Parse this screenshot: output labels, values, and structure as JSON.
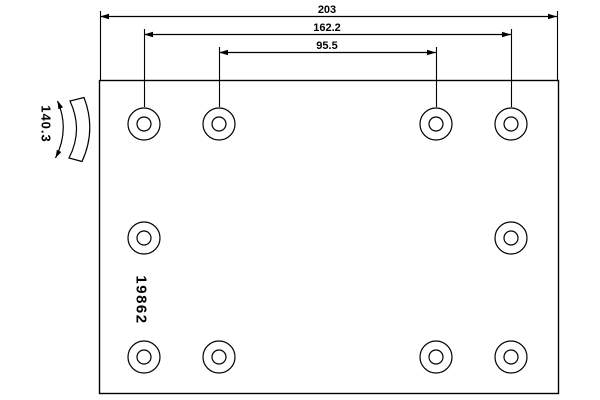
{
  "drawing": {
    "part_number": "19862",
    "dimensions": {
      "total_width": "203",
      "outer_hole_span": "162.2",
      "inner_hole_span": "95.5",
      "lining_width": "140.3"
    },
    "colors": {
      "line": "#000000",
      "background": "#ffffff"
    },
    "geometry": {
      "plate": {
        "x": 99,
        "y": 80,
        "width": 459,
        "height": 313
      },
      "holes": {
        "columns_x": [
          144,
          219,
          436,
          511
        ],
        "rows_y": [
          124,
          238,
          357
        ],
        "pattern": [
          [
            1,
            1,
            1,
            1
          ],
          [
            1,
            0,
            0,
            1
          ],
          [
            1,
            1,
            1,
            1
          ]
        ],
        "outer_r": 16,
        "inner_r": 7
      },
      "h_dims": [
        {
          "key": "total_width",
          "y": 16,
          "x1": 100,
          "x2": 557,
          "ext_top": 11,
          "ext_bottom": 80
        },
        {
          "key": "outer_hole_span",
          "y": 34,
          "x1": 144,
          "x2": 511,
          "ext_top": 29,
          "ext_bottom": 107
        },
        {
          "key": "inner_hole_span",
          "y": 52,
          "x1": 219,
          "x2": 436,
          "ext_top": 47,
          "ext_bottom": 107
        }
      ]
    }
  }
}
